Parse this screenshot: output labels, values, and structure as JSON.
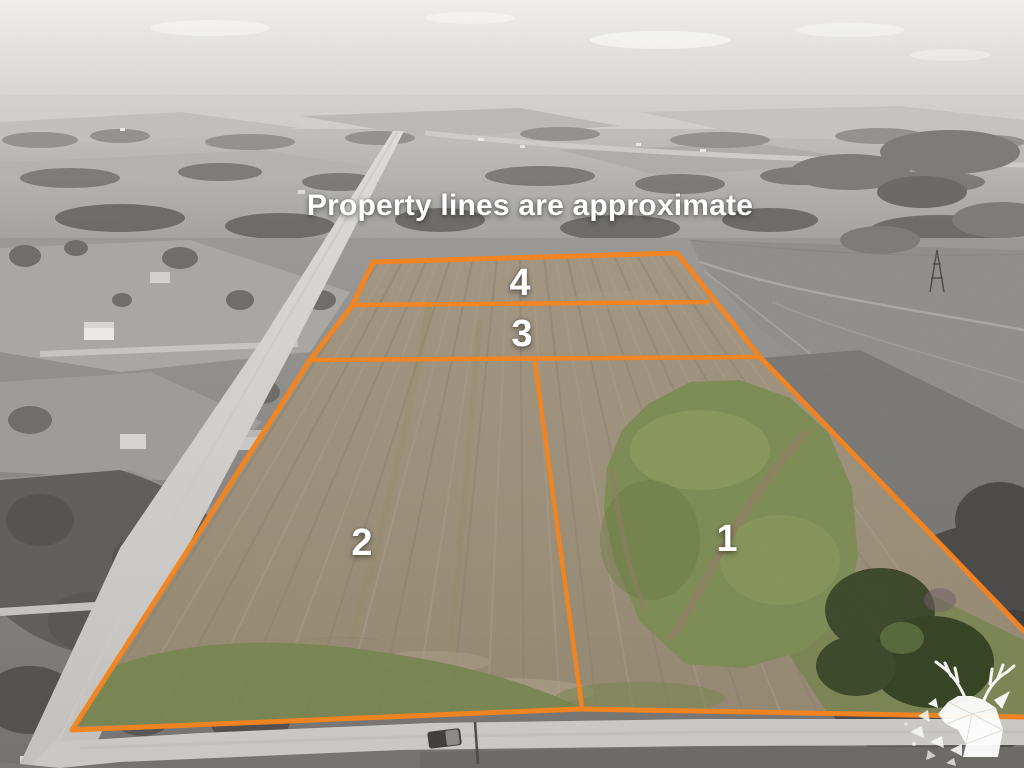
{
  "photo": {
    "disclaimer": "Property lines are approximate"
  },
  "lots": [
    {
      "number": "1"
    },
    {
      "number": "2"
    },
    {
      "number": "3"
    },
    {
      "number": "4"
    }
  ],
  "branding": {
    "logo_icon": "deer-logo"
  },
  "colors": {
    "boundary_line": "#F5831E",
    "overlay_text": "#FFFFFF"
  }
}
